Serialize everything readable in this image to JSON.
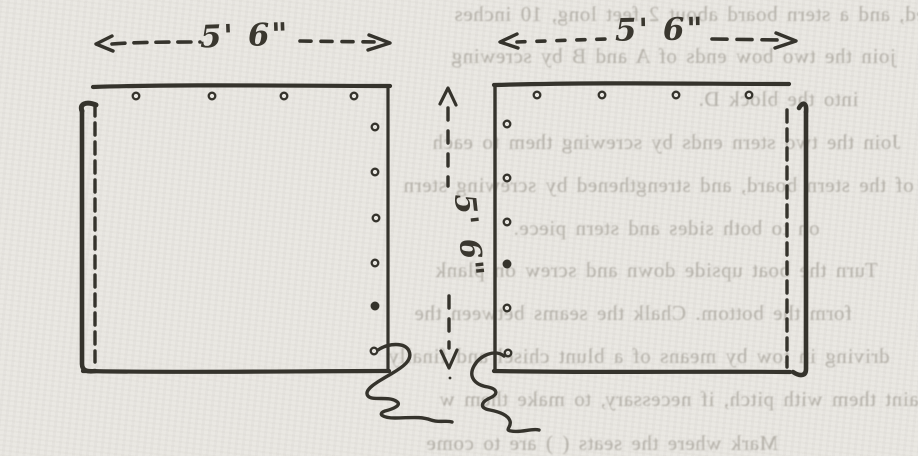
{
  "page": {
    "kind": "scanned book page with hand-drawn boat-building diagram",
    "colors": {
      "paper": "#e8e6e1",
      "ink": "#35332c",
      "show_through_text": "#8a857b"
    }
  },
  "diagram": {
    "labels": {
      "left_panel_width": "5' 6\"",
      "right_panel_width": "5' 6\"",
      "middle_height": "5' 6\""
    },
    "left_panel": {
      "screw_holes_top": 4,
      "screw_holes_right": 6,
      "dashed_edge": "left",
      "break_squiggle": "bottom-right"
    },
    "right_panel": {
      "screw_holes_top": 4,
      "screw_holes_left": 6,
      "dashed_edge": "right",
      "break_squiggle": "bottom-left"
    }
  },
  "show_through": {
    "mirrored": true,
    "lines": [
      "eed, and a stern board about 2 feet long, 10 inches",
      "join the two bow ends of A and B by screwing",
      "into the block D.",
      "Join the two stern ends by screwing them to each",
      "of the stern board, and strengthened by screwing stern",
      "on to both sides and stern piece.",
      "Turn the boat upside down and screw on plank",
      "form the bottom.  Chalk the seams between the",
      "driving in tow by means of a blunt chisel and finally",
      "paint them with pitch, if necessary, to make them w",
      "Mark where the seats ( ) are to come"
    ]
  }
}
